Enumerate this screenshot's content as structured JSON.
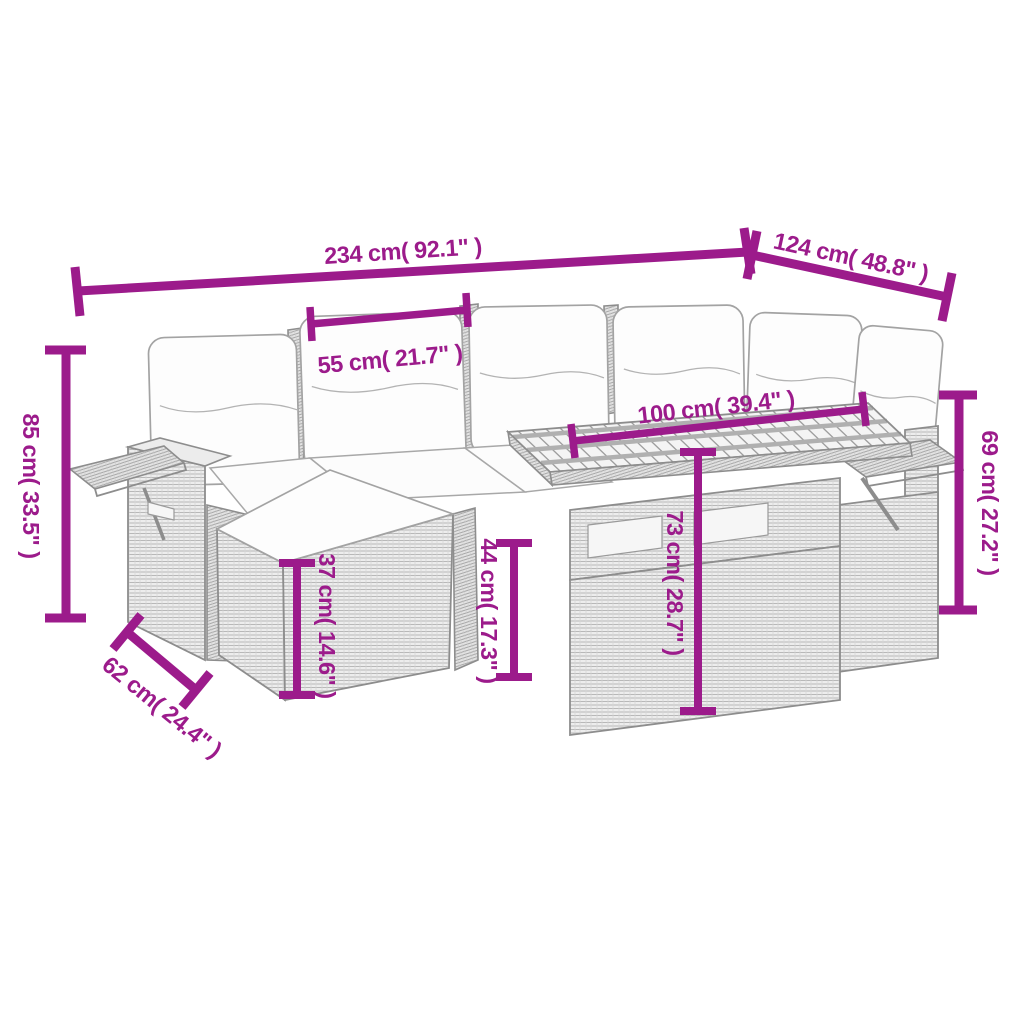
{
  "colors": {
    "dimension": "#9C1B8B",
    "furniture_outline": "#8d8d8d",
    "rattan_fill": "#ededed",
    "cushion_fill": "#fdfdfd",
    "background": "#ffffff"
  },
  "dimensions": {
    "overall_width": {
      "label": "234 cm( 92.1\" )"
    },
    "overall_depth": {
      "label": "124 cm( 48.8\" )"
    },
    "seat_width": {
      "label": "55 cm( 21.7\" )"
    },
    "table_length": {
      "label": "100 cm( 39.4\" )"
    },
    "back_height_left": {
      "label": "85 cm( 33.5\" )"
    },
    "back_height_right": {
      "label": "69 cm( 27.2\" )"
    },
    "footstool_height": {
      "label": "37 cm( 14.6\" )"
    },
    "seat_height": {
      "label": "44 cm( 17.3\" )"
    },
    "table_height": {
      "label": "73 cm( 28.7\" )"
    },
    "footstool_depth": {
      "label": "62 cm( 24.4\" )"
    }
  }
}
